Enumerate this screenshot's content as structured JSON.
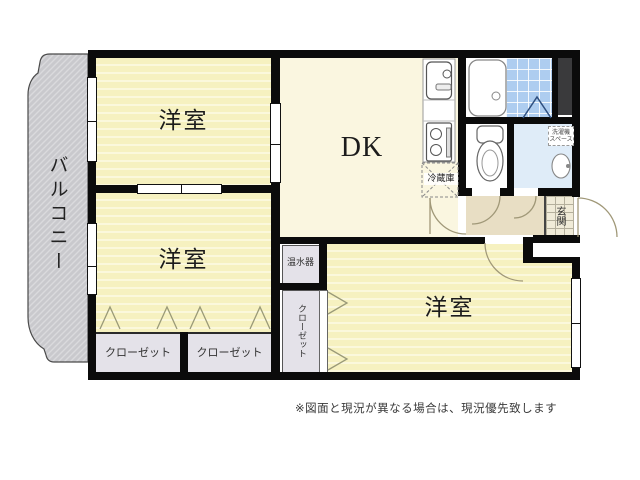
{
  "floorplan": {
    "balcony_label": "バルコニー",
    "bedroom1_label": "洋室",
    "bedroom2_label": "洋室",
    "bedroom3_label": "洋室",
    "dk_label": "DK",
    "closet1_label": "クローゼット",
    "closet2_label": "クローゼット",
    "closet3_label": "クローゼット",
    "water_heater_label": "温水器",
    "fridge_label": "冷蔵庫",
    "laundry_label_line1": "洗濯機",
    "laundry_label_line2": "スペース",
    "entrance_label": "玄関",
    "disclaimer": "※図面と現況が異なる場合は、現況優先致します",
    "colors": {
      "room_yellow": "#f6f1c0",
      "room_stripe": "#fbf8dc",
      "dk_cream": "#faf6e0",
      "balcony_gray": "#c9c9cd",
      "closet_gray": "#e4e2e9",
      "hall_tan": "#e8dec4",
      "washroom_blue": "#dfecf8",
      "bath_tile_blue": "#aecdf0",
      "entrance_tile": "#f0ebd8",
      "wall_black": "#0b0b0b",
      "pillar_dark": "#3a3a3c"
    }
  }
}
